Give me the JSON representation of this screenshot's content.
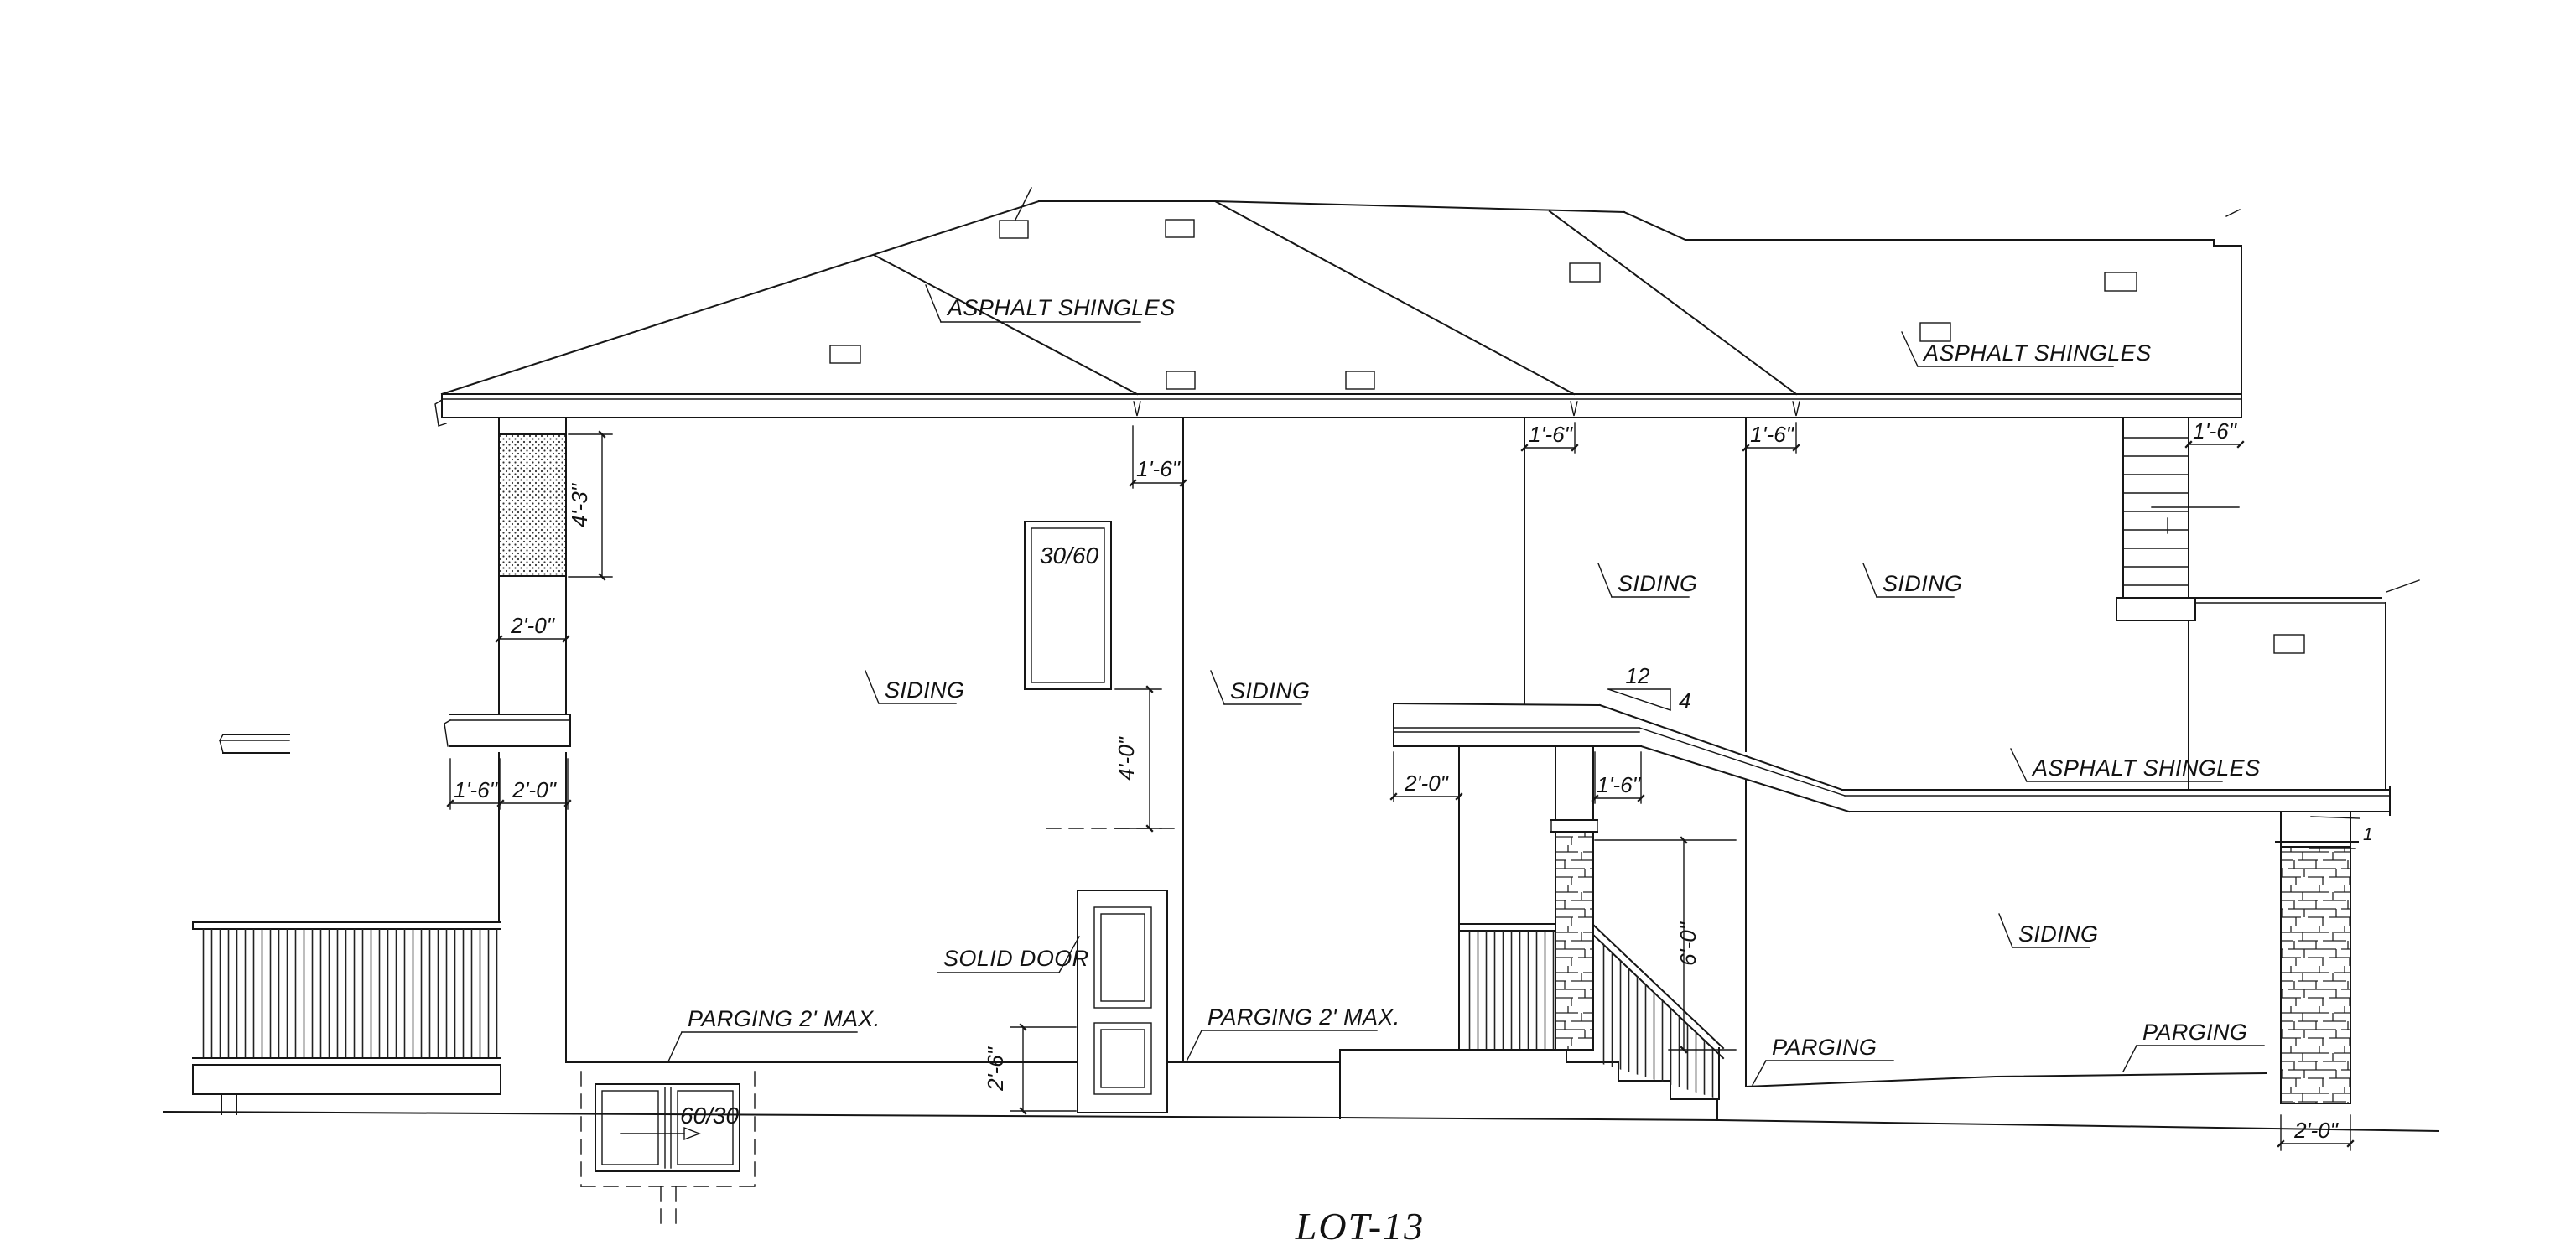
{
  "drawing_title": "LOT-13",
  "labels": {
    "asphalt_shingles": "ASPHALT SHINGLES",
    "siding": "SIDING",
    "parging_max": "PARGING 2' MAX.",
    "parging": "PARGING",
    "solid_door": "SOLID DOOR"
  },
  "window_tags": {
    "upper": "30/60",
    "basement": "60/30"
  },
  "slope": {
    "rise": "12",
    "run": "4"
  },
  "notes": {
    "cap": "1"
  },
  "dims": {
    "d4_3": "4'-3\"",
    "d2_0": "2'-0\"",
    "d1_6": "1'-6\"",
    "d4_0": "4'-0\"",
    "d2_6": "2'-6\"",
    "d6_0": "6'-0\""
  }
}
